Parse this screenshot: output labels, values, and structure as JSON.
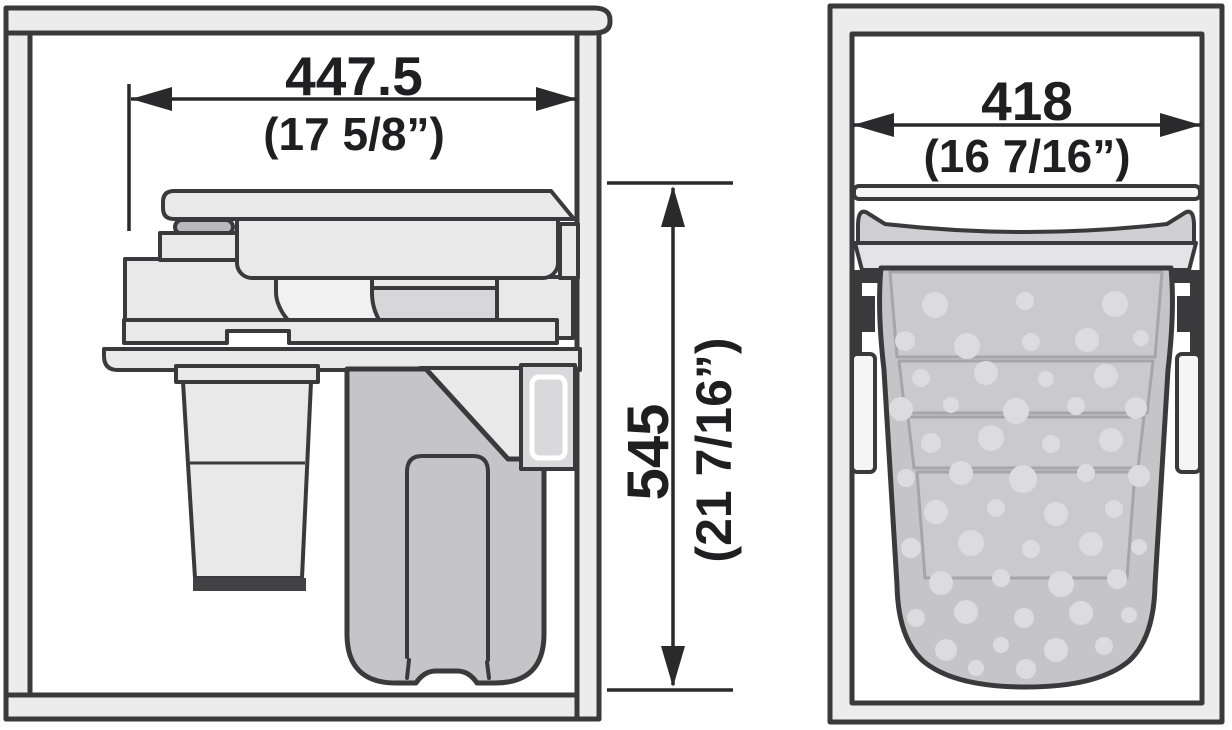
{
  "figures": {
    "side_view": {
      "width": {
        "mm": "447.5",
        "inches": "(17 5/8”)"
      },
      "height": {
        "mm": "545",
        "inches": "(21 7/16”)"
      }
    },
    "front_view": {
      "width": {
        "mm": "418",
        "inches": "(16 7/16”)"
      }
    }
  },
  "colors": {
    "background": "#ffffff",
    "outline": "#3a3a3c",
    "dimension_line": "#2a2a2c",
    "text": "#1f1f21",
    "cabinet_panel": "#ececed",
    "mechanism": "#e9e9ea",
    "mechanism_dark": "#d7d7d9",
    "lid_top": "#d0d0d2",
    "lid_band": "#e4e4e6",
    "bag": "#c5c5c7",
    "bag_step": "#cacacc",
    "perforation_dot": "#dcdcde",
    "mounting_plate": "#d9d9db",
    "hardware": "#3a3a3c",
    "container_base": "#424244"
  }
}
